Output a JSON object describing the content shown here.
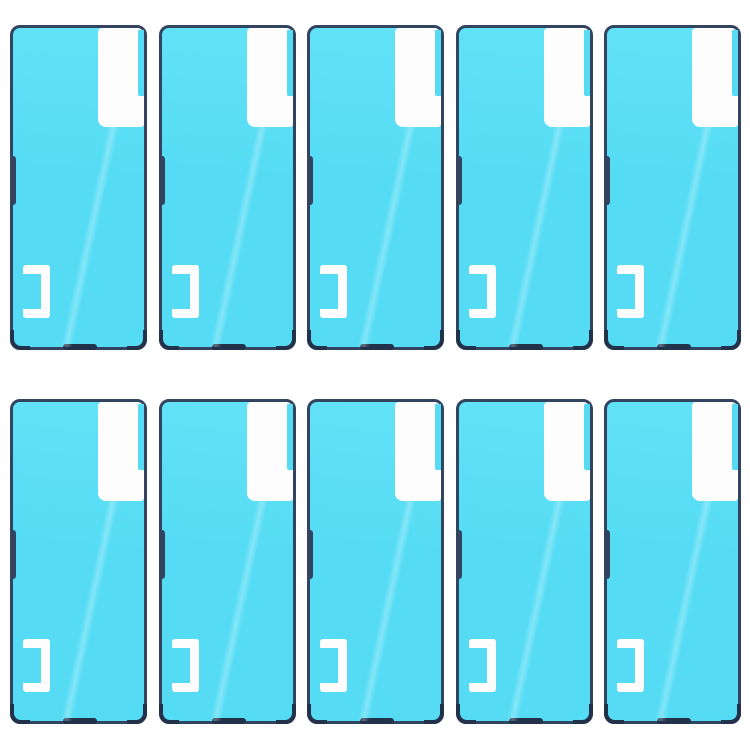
{
  "meta": {
    "description": "Product photo of 10 identical phone rear-housing adhesive sticker sheets arranged in a grid",
    "sheet_count": 10,
    "grid": {
      "rows": 2,
      "columns": 5
    }
  },
  "colors": {
    "page_background": "#ffffff",
    "adhesive_cyan": "#55dcf4",
    "adhesive_cyan_highlight": "#63e2f7",
    "outline_navy": "#334461",
    "accent_dark_navy": "#22324a",
    "cutout_white": "#fdfdfe"
  },
  "sheet_features": {
    "peel_tab": "white peel-tab cutout at top right",
    "peel_tab_gap": "thin cyan gap along upper right edge of tab",
    "side_notch": "dark side-button notch on left edge",
    "bracket": "white right-square-bracket cutout at lower left",
    "bottom_mark": "dark port mark centered on bottom edge",
    "corners": "thicker dark bottom corner accents"
  }
}
